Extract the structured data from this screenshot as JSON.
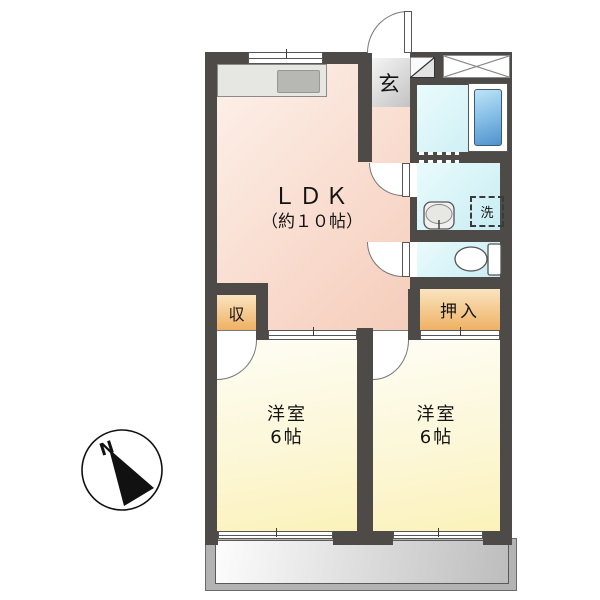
{
  "floorplan": {
    "compass": {
      "label": "N"
    },
    "entrance": {
      "label": "玄"
    },
    "ldk": {
      "name": "ＬＤＫ",
      "size": "（約１０帖）"
    },
    "closet": {
      "label": "収"
    },
    "oshiire": {
      "label": "押入"
    },
    "laundry": {
      "label": "洗"
    },
    "bedroom1": {
      "name": "洋室",
      "size": "6帖"
    },
    "bedroom2": {
      "name": "洋室",
      "size": "6帖"
    },
    "colors": {
      "wall": "#4d4a48",
      "ldk_floor": "#f5cdbb",
      "bedroom_floor": "#fbf2ba",
      "storage_floor": "#efb163",
      "wetroom_floor": "#c8edf3",
      "bathtub": "#4e92cc",
      "entrance_floor": "#c3c3c3",
      "balcony": "#b3b3b3"
    }
  }
}
